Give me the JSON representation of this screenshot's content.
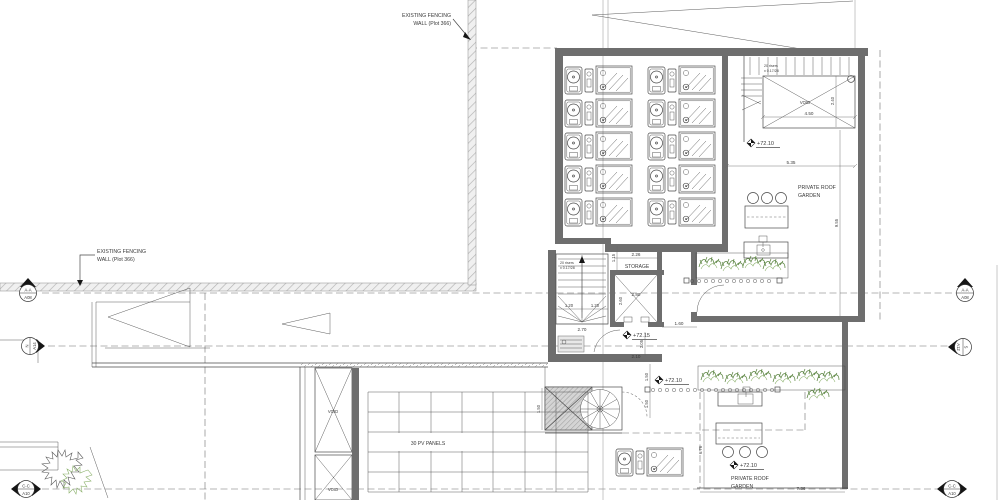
{
  "drawing": {
    "annotations": {
      "fence": {
        "line1": "EXISTING FENCING",
        "line2": "WALL (Plot 366)"
      }
    },
    "labels": {
      "storage": "STORAGE",
      "garden_line1": "PRIVATE ROOF",
      "garden_line2": "GARDEN",
      "pv": "30 PV PANELS",
      "void": "VOID"
    },
    "levels": {
      "top_garden": "+72.10",
      "core": "+72.15",
      "landing": "+72.10",
      "bottom_garden": "+72.10"
    },
    "stair_note": {
      "line1": "20 risers",
      "line2": "x 0.17/28"
    },
    "dimensions": {
      "d450": "4.50",
      "d240": "2.40",
      "d535": "5.35",
      "d955": "9.55",
      "d226": "2.26",
      "d115": "1.15",
      "d280": "2.80",
      "d260": "2.60",
      "d120": "1.20",
      "d270": "2.70",
      "d160": "1.60",
      "d205": "2.05",
      "d210": "2.10",
      "d150": "1.50",
      "d676": "6.76",
      "d736": "7.36"
    },
    "markers": {
      "aa": {
        "name": "A-A",
        "sheet": "A08"
      },
      "n_left": {
        "name": "N",
        "sheet": "A14"
      },
      "s_right": {
        "name": "S",
        "sheet": "A12"
      },
      "cc": {
        "name": "C-C",
        "sheet": "A10"
      }
    },
    "colors": {
      "line": "#4a4a4a",
      "wall": "#6e6e6e",
      "plant_dark": "#55803a",
      "plant_light": "#8ab06a"
    }
  }
}
